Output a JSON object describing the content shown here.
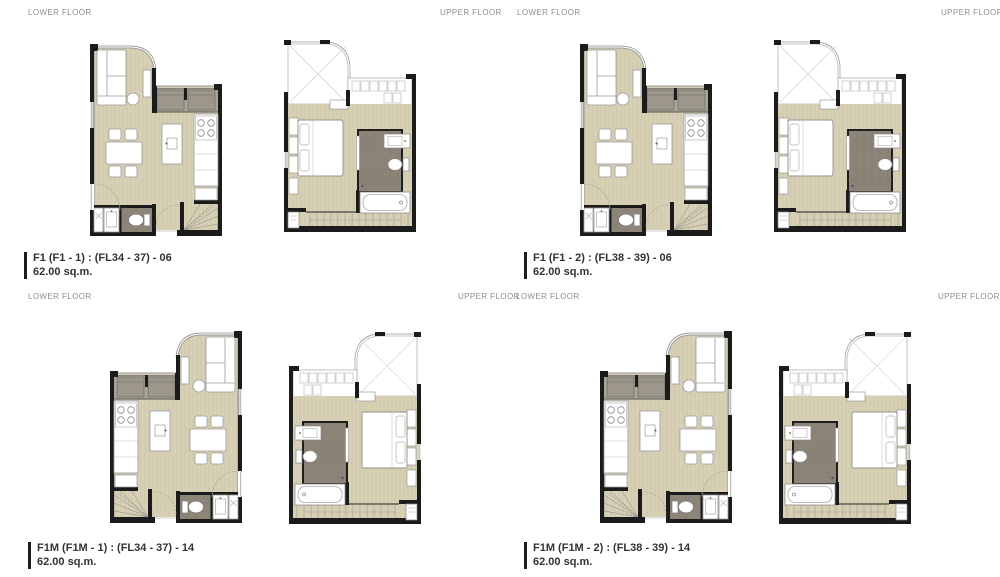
{
  "colors": {
    "wall": "#1b1b1b",
    "floor": "#d9d2b6",
    "floor_stripe": "#c9c1a5",
    "balcony": "#aaa698",
    "balcony_unit": "#9c978a",
    "bathroom": "#8d8478",
    "furniture_stroke": "#9a9a9a",
    "header_text": "#8d8d95",
    "label_text": "#333333"
  },
  "quadrants": [
    {
      "lower_floor_label": "LOWER FLOOR",
      "upper_floor_label": "UPPER FLOOR",
      "unit_name": "F1 (F1 - 1) : (FL34 - 37) - 06",
      "unit_area": "62.00 sq.m."
    },
    {
      "lower_floor_label": "LOWER FLOOR",
      "upper_floor_label": "UPPER FLOOR",
      "unit_name": "F1 (F1 - 2) : (FL38 - 39) - 06",
      "unit_area": "62.00 sq.m."
    },
    {
      "lower_floor_label": "LOWER FLOOR",
      "upper_floor_label": "UPPER FLOOR",
      "unit_name": "F1M (F1M - 1) : (FL34 - 37) - 14",
      "unit_area": "62.00 sq.m."
    },
    {
      "lower_floor_label": "LOWER FLOOR",
      "upper_floor_label": "UPPER FLOOR",
      "unit_name": "F1M (F1M - 2) : (FL38 - 39) - 14",
      "unit_area": "62.00 sq.m."
    }
  ]
}
